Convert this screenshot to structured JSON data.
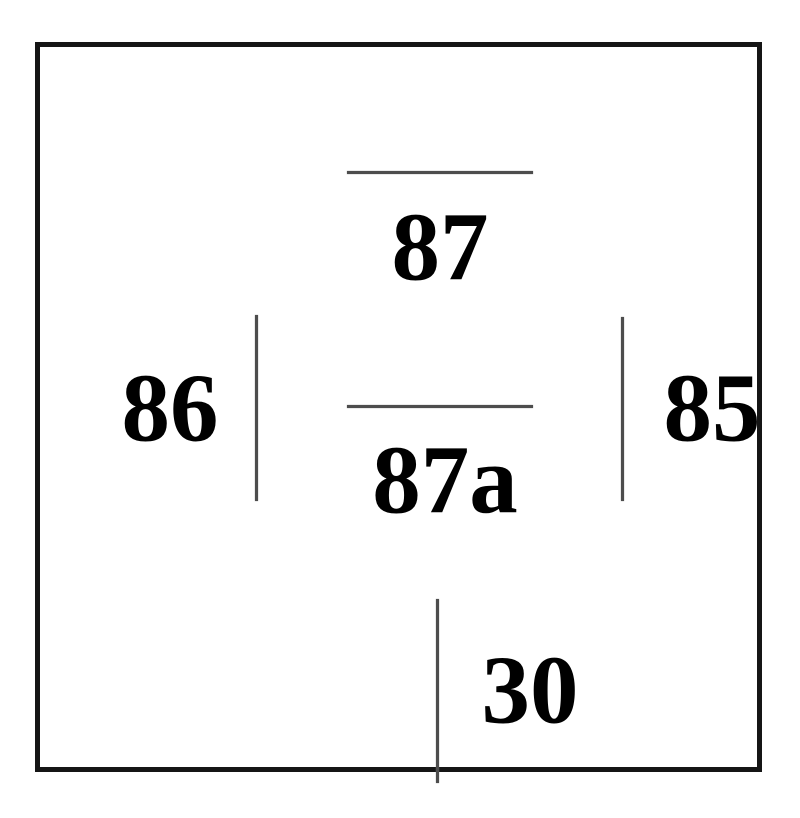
{
  "diagram": {
    "title": "relay-pinout",
    "colors": {
      "background": "#ffffff",
      "outline": "#151515",
      "pin_line": "#4d4d4d",
      "text": "#000000"
    },
    "pins": {
      "p87": {
        "label": "87"
      },
      "p87a": {
        "label": "87a"
      },
      "p86": {
        "label": "86"
      },
      "p85": {
        "label": "85"
      },
      "p30": {
        "label": "30"
      }
    }
  }
}
